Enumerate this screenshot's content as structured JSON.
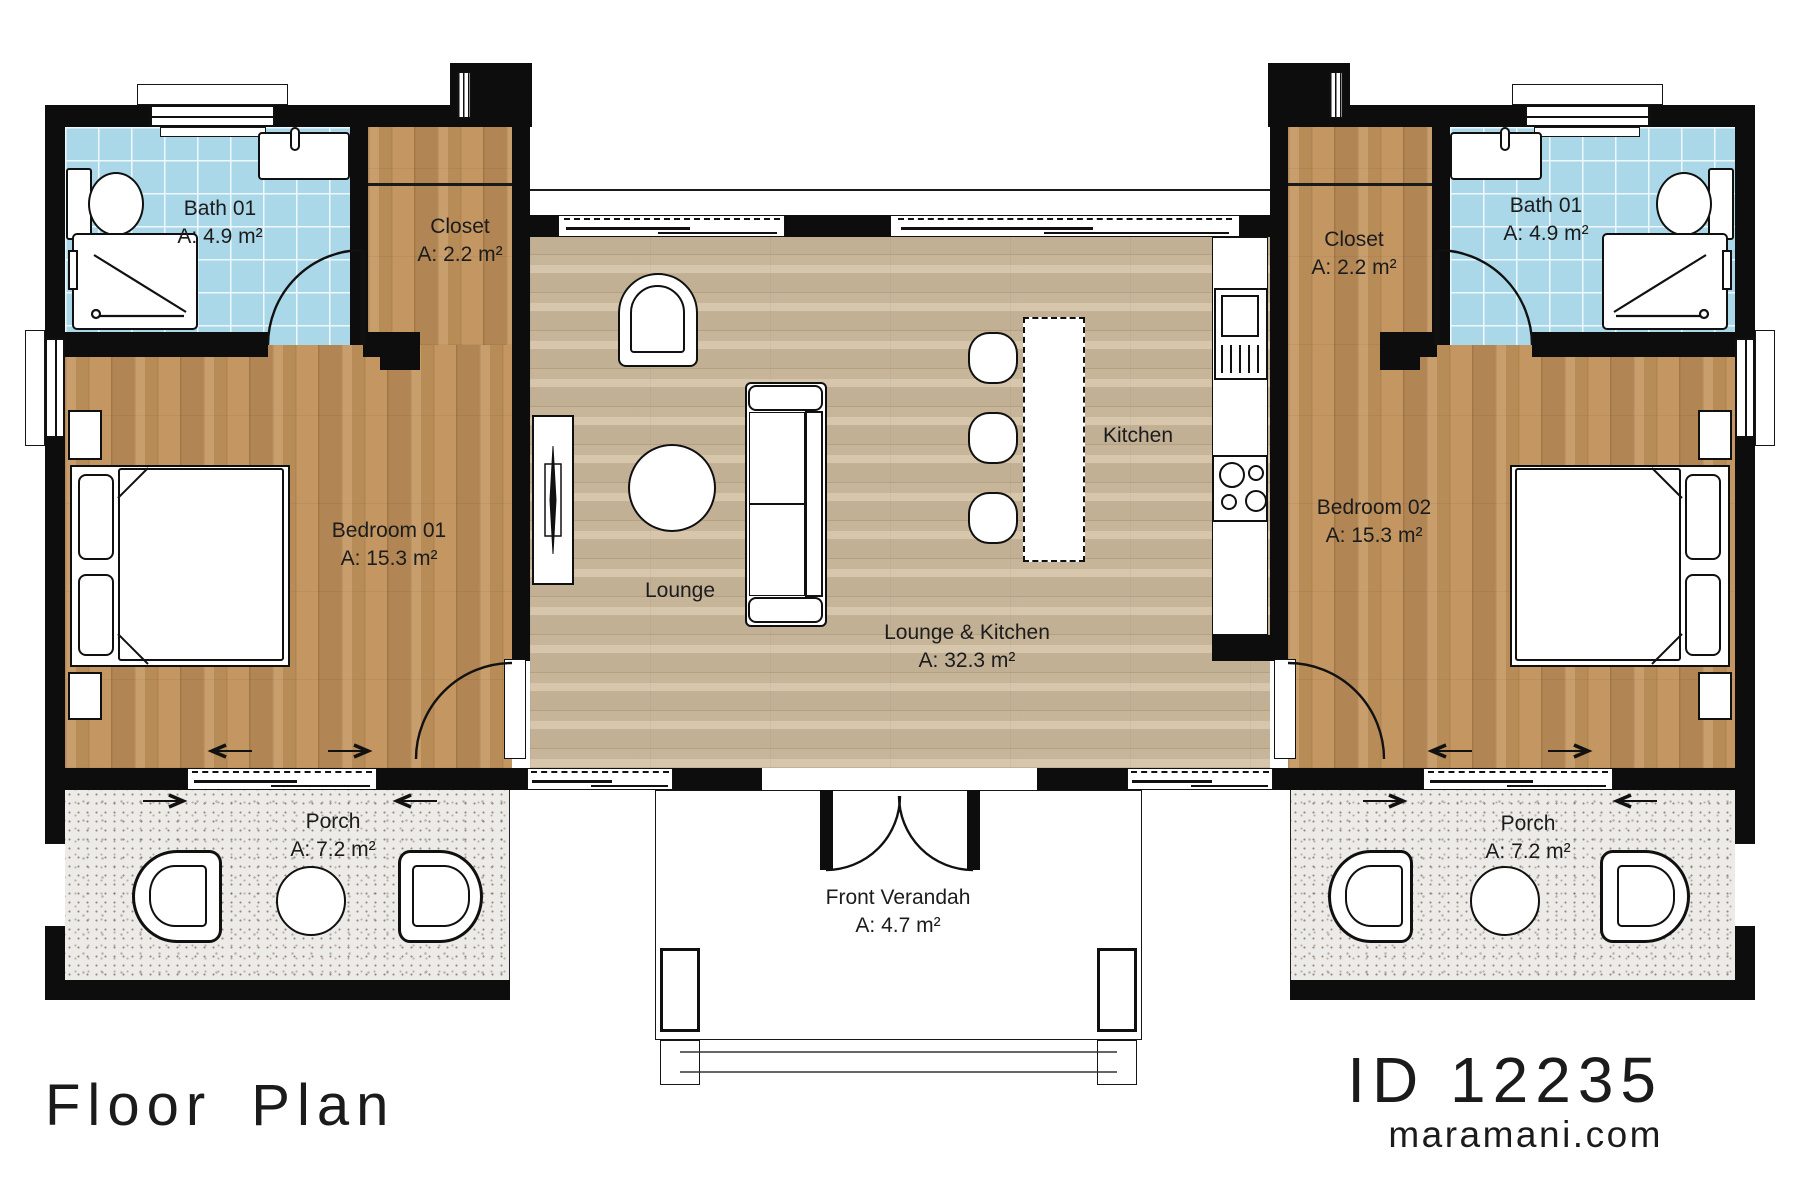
{
  "title": "Floor Plan",
  "branding": {
    "plan_id": "ID 12235",
    "website": "maramani.com"
  },
  "rooms": {
    "bath_left": {
      "name": "Bath 01",
      "area": "A: 4.9 m²"
    },
    "closet_left": {
      "name": "Closet",
      "area": "A: 2.2 m²"
    },
    "bedroom_01": {
      "name": "Bedroom 01",
      "area": "A: 15.3 m²"
    },
    "porch_left": {
      "name": "Porch",
      "area": "A: 7.2 m²"
    },
    "lounge_zone": {
      "name": "Lounge"
    },
    "kitchen_zone": {
      "name": "Kitchen"
    },
    "lounge_kitchen": {
      "name": "Lounge & Kitchen",
      "area": "A: 32.3 m²"
    },
    "front_verandah": {
      "name": "Front Verandah",
      "area": "A: 4.7 m²"
    },
    "closet_right": {
      "name": "Closet",
      "area": "A: 2.2 m²"
    },
    "bath_right": {
      "name": "Bath 01",
      "area": "A: 4.9 m²"
    },
    "bedroom_02": {
      "name": "Bedroom 02",
      "area": "A: 15.3 m²"
    },
    "porch_right": {
      "name": "Porch",
      "area": "A: 7.2 m²"
    }
  },
  "colors": {
    "wall": "#0d0d0d",
    "bedroom_floor": "#c2935c",
    "lounge_floor": "#d2bfa2",
    "bath_tile": "#abd8e9",
    "porch_floor": "#edebe7"
  }
}
